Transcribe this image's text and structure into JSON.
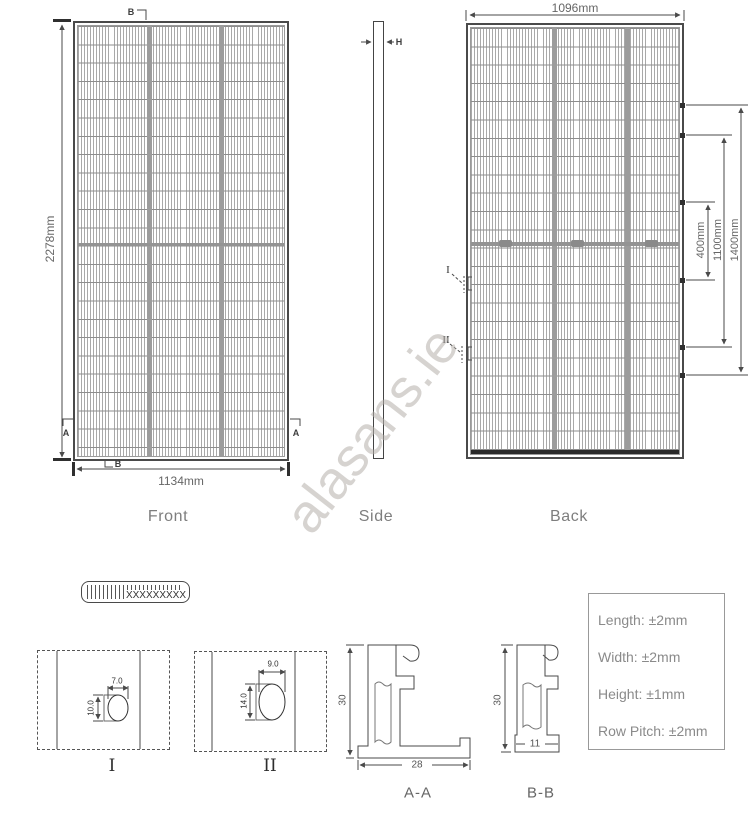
{
  "watermark": "alasans.ie",
  "front": {
    "label": "Front",
    "height": "2278mm",
    "width": "1134mm",
    "cut_b": "B",
    "cut_a": "A"
  },
  "side": {
    "label": "Side",
    "thickness": "H"
  },
  "back": {
    "label": "Back",
    "width": "1096mm",
    "dim_inner": "400mm",
    "dim_mid": "1100mm",
    "dim_outer": "1400mm",
    "marker_1": "I",
    "marker_2": "II"
  },
  "barcode": {
    "text": "XXXXXXXXX"
  },
  "detail_1": {
    "label": "I",
    "hole_width": "7.0",
    "hole_height": "10.0"
  },
  "detail_2": {
    "label": "II",
    "hole_width": "9.0",
    "hole_height": "14.0"
  },
  "section_aa": {
    "label": "A-A",
    "height": "30",
    "width": "28"
  },
  "section_bb": {
    "label": "B-B",
    "height": "30",
    "width": "11"
  },
  "tolerances": {
    "length": "Length: ±2mm",
    "width": "Width: ±2mm",
    "height": "Height: ±1mm",
    "row_pitch": "Row Pitch: ±2mm"
  },
  "colors": {
    "line": "#4a4a4a",
    "grid": "#9c9c9c",
    "label_gray": "#7e7e7e",
    "watermark_gray": "#b5b0ab"
  }
}
